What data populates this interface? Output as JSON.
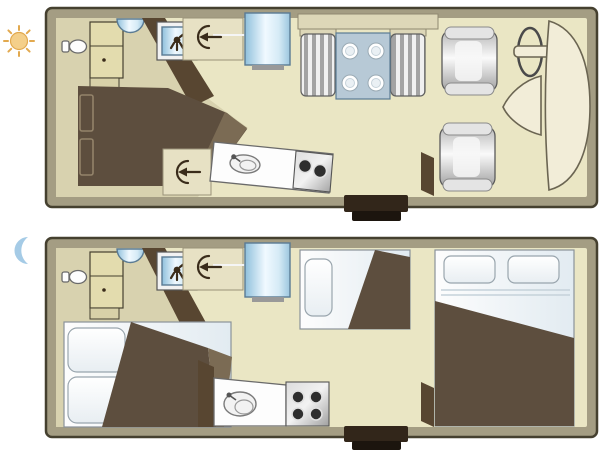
{
  "page": {
    "background": "#ffffff",
    "description": "Motorhome floor plan, day and night configurations"
  },
  "palette": {
    "wall": "#a49d83",
    "wall_outline": "#45402f",
    "floor_main": "#eae6c4",
    "floor_side": "#d8d2af",
    "cabinet": "#e3dcae",
    "cabinet_dark": "#d8d1a8",
    "shelf": "#ddd7b8",
    "panel": "#e7e1c4",
    "dark_wood": "#584631",
    "bed_brown": "#5d4e3e",
    "bed_brown_edge": "#7b6b54",
    "blue_dark": "#5a7b94",
    "table_blue": "#b7c9d6",
    "burner": "#2e2e2e",
    "step_dark": "#32261a",
    "step_darker": "#1c150e",
    "cream": "#f2edd8",
    "sun": "#f4cf8a",
    "sun_stroke": "#e2a94f",
    "moon": "#a5cbe6"
  },
  "legend": {
    "day_icon": "sun-icon",
    "night_icon": "moon-icon"
  },
  "plans": [
    {
      "name": "day-layout",
      "mode": "day",
      "features": [
        "toilet",
        "wardrobe",
        "washbasin",
        "shower",
        "roof-vent-front",
        "roof-vent-mid",
        "refrigerator",
        "rear-double-bed",
        "dinette-bench-left",
        "dinette-bench-right",
        "dinette-table",
        "four-place-settings",
        "kitchen-counter-angled",
        "kitchen-sink",
        "two-burner-stove",
        "entry-door",
        "entry-step",
        "driver-seat",
        "passenger-seat",
        "steering-wheel",
        "engine-hood",
        "windshield",
        "overhead-locker"
      ]
    },
    {
      "name": "night-layout",
      "mode": "night",
      "features": [
        "toilet",
        "wardrobe",
        "washbasin",
        "shower",
        "roof-vent-front",
        "refrigerator",
        "rear-double-bed-made-up",
        "rear-bed-pillow-1",
        "rear-bed-pillow-2",
        "dinette-converted-bed",
        "dinette-bed-pillow",
        "overcab-double-bed",
        "overcab-pillow-1",
        "overcab-pillow-2",
        "kitchen-counter-straight",
        "kitchen-sink",
        "four-burner-stove",
        "entry-door",
        "entry-step"
      ]
    }
  ]
}
